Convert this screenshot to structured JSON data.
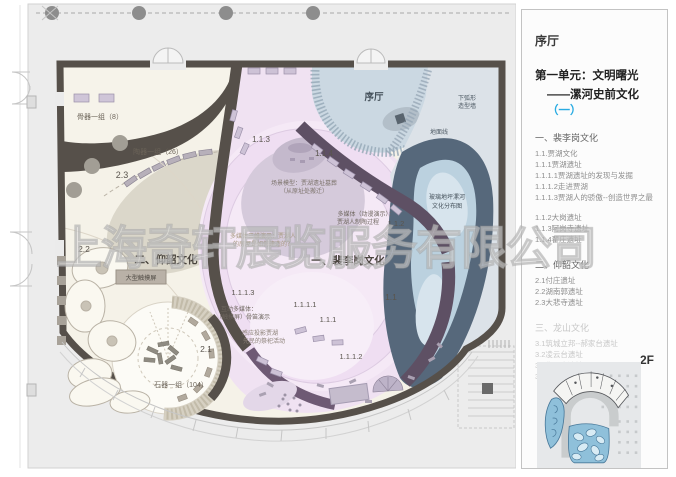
{
  "watermark": "上海奇轩展览服务有限公司",
  "colors": {
    "accent": "#29abe2",
    "wall": "#56504a",
    "peiligang_zone": "#f0e2f2",
    "yangshao_zone": "#f6f3ea",
    "hall_zone": "#cbd8e2",
    "glass_zone": "#bbd1df",
    "minimap_highlight": "#8fc0da"
  },
  "plan": {
    "hall_label": "序厅",
    "bone_group": "骨器一组（8）",
    "pottery_group": "陶器一组（26）",
    "stone_group": "石器一组（104）",
    "large_touch_screen": "大型触摸屏",
    "unit1_label": "一、裴李岗文化",
    "unit2_label": "二、仰韶文化",
    "scene_model_line1": "场景模型：贾湖遗址墓葬",
    "scene_model_line2": "（从原址处搬迁）",
    "anim_media_line1": "多媒体（动漫演示）：",
    "anim_media_line2": "贾湖人制陶过程",
    "media3d_line1": "多媒体三维演示：贾湖人",
    "media3d_line2": "的房屋是如何建造的？",
    "interactive_line1": "互动多媒体：",
    "interactive_line2": "（触摸屏）骨笛演示",
    "sensor_line1": "感应投影贾湖",
    "sensor_line2": "先民的祭祀活动",
    "arc_wall_line1": "下弧形",
    "arc_wall_line2": "造型墙",
    "ground_line": "地面线",
    "glass_floor_line1": "玻璃地坪漯河",
    "glass_floor_line2": "文化分布图",
    "codes": {
      "c23": "2.3",
      "c22": "2.2",
      "c21": "2.1",
      "c113": "1.1.3",
      "c114": "1.1.4",
      "c112": "1.1.2",
      "c11": "1.1",
      "c111": "1.1.1",
      "c1111": "1.1.1.1",
      "c1112": "1.1.1.2",
      "c1113": "1.1.1.3"
    }
  },
  "panel": {
    "hall_title": "序厅",
    "unit_title": "第一单元：文明曙光",
    "unit_subtitle": "——漯河史前文化",
    "unit_subtitle_accent": "（一）",
    "floor_label": "2F",
    "sections": [
      {
        "heading": "一、裴李岗文化",
        "items_a": [
          "1.1.贾湖文化",
          "1.1.1贾湖遗址",
          "1.1.1.1贾湖遗址的发现与发掘",
          "1.1.1.2走进贾湖",
          "1.1.1.3贾湖人的骄傲--创造世界之最"
        ],
        "items_b": [
          "1.1.2大岗遗址",
          "1.1.3阿岗寺遗址",
          "1.1.4翟庄遗址"
        ]
      },
      {
        "heading": "二、仰韶文化",
        "items": [
          "2.1付庄遗址",
          "2.2湖南郭遗址",
          "2.3大悲寺遗址"
        ]
      },
      {
        "heading": "三、龙山文化",
        "items": [
          "3.1筑城立邦--郝家台遗址",
          "3.2凌云台遗址",
          "3.3华严寺遗址",
          "3.4漯河市其它龙山文化遗址"
        ]
      }
    ]
  }
}
